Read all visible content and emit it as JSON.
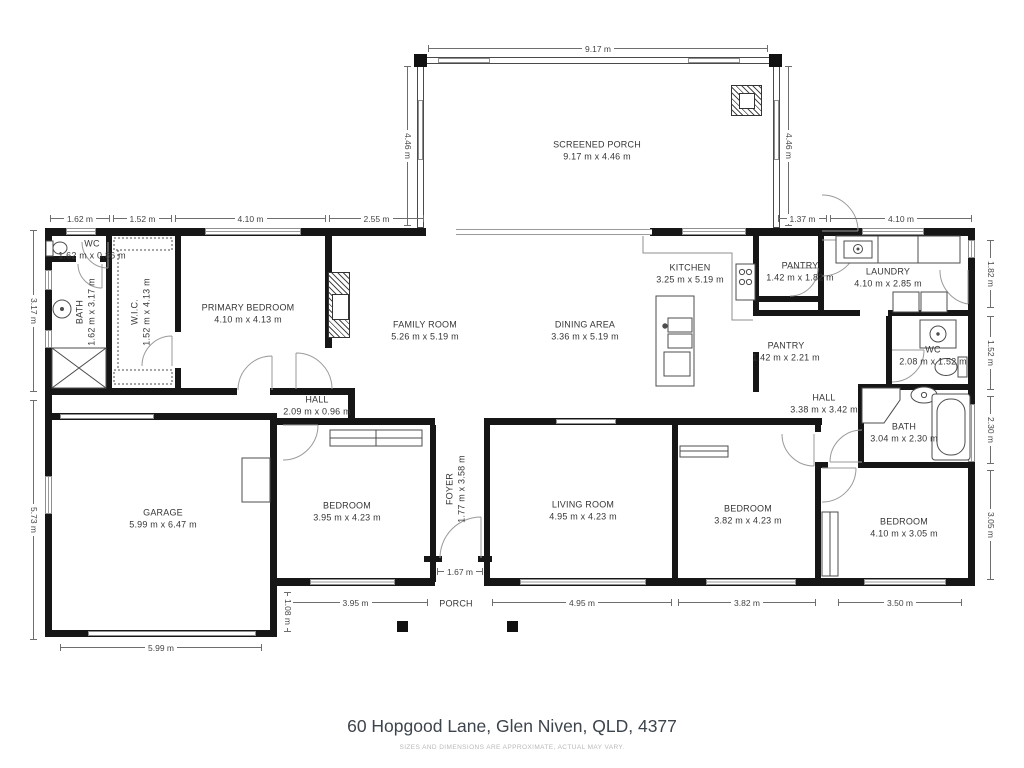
{
  "title": "60 Hopgood Lane, Glen Niven, QLD, 4377",
  "disclaimer": "SIZES AND DIMENSIONS ARE APPROXIMATE, ACTUAL MAY VARY.",
  "rooms": [
    {
      "name": "SCREENED PORCH",
      "dims": "9.17 m x 4.46 m"
    },
    {
      "name": "WC",
      "dims": "1.62 m x 0.86 m"
    },
    {
      "name": "BATH",
      "dims": "1.62 m x 3.17 m"
    },
    {
      "name": "W.I.C.",
      "dims": "1.52 m x 4.13 m"
    },
    {
      "name": "PRIMARY BEDROOM",
      "dims": "4.10 m x 4.13 m"
    },
    {
      "name": "FAMILY ROOM",
      "dims": "5.26 m x 5.19 m"
    },
    {
      "name": "DINING AREA",
      "dims": "3.36 m x 5.19 m"
    },
    {
      "name": "KITCHEN",
      "dims": "3.25 m x 5.19 m"
    },
    {
      "name": "PANTRY",
      "dims": "1.42 m x 1.82 m"
    },
    {
      "name": "LAUNDRY",
      "dims": "4.10 m x 2.85 m"
    },
    {
      "name": "PANTRY",
      "dims": "1.42 m x 2.21 m"
    },
    {
      "name": "WC",
      "dims": "2.08 m x 1.52 m"
    },
    {
      "name": "HALL",
      "dims": "2.09 m x 0.96 m"
    },
    {
      "name": "HALL",
      "dims": "3.38 m x 3.42 m"
    },
    {
      "name": "BATH",
      "dims": "3.04 m x 2.30 m"
    },
    {
      "name": "GARAGE",
      "dims": "5.99 m x 6.47 m"
    },
    {
      "name": "BEDROOM",
      "dims": "3.95 m x 4.23 m"
    },
    {
      "name": "FOYER",
      "dims": "1.77 m x 3.58 m"
    },
    {
      "name": "LIVING ROOM",
      "dims": "4.95 m x 4.23 m"
    },
    {
      "name": "BEDROOM",
      "dims": "3.82 m x 4.23 m"
    },
    {
      "name": "BEDROOM",
      "dims": "4.10 m x 3.05 m"
    },
    {
      "name": "PORCH",
      "dims": ""
    }
  ],
  "dimensions": {
    "porch_top": "9.17 m",
    "porch_left": "4.46 m",
    "porch_right": "4.46 m",
    "top_1": "1.62 m",
    "top_2": "1.52 m",
    "top_3": "4.10 m",
    "top_4": "2.55 m",
    "top_5": "1.37 m",
    "top_6": "4.10 m",
    "left_1": "3.17 m",
    "left_2": "5.73 m",
    "right_1": "1.82 m",
    "right_2": "1.52 m",
    "right_3": "2.30 m",
    "right_4": "3.05 m",
    "bottom_1": "3.95 m",
    "bottom_2": "1.67 m",
    "bottom_3": "4.95 m",
    "bottom_4": "3.82 m",
    "bottom_5": "3.50 m",
    "bottom_garage": "5.99 m",
    "side_small": "1.08 m"
  }
}
